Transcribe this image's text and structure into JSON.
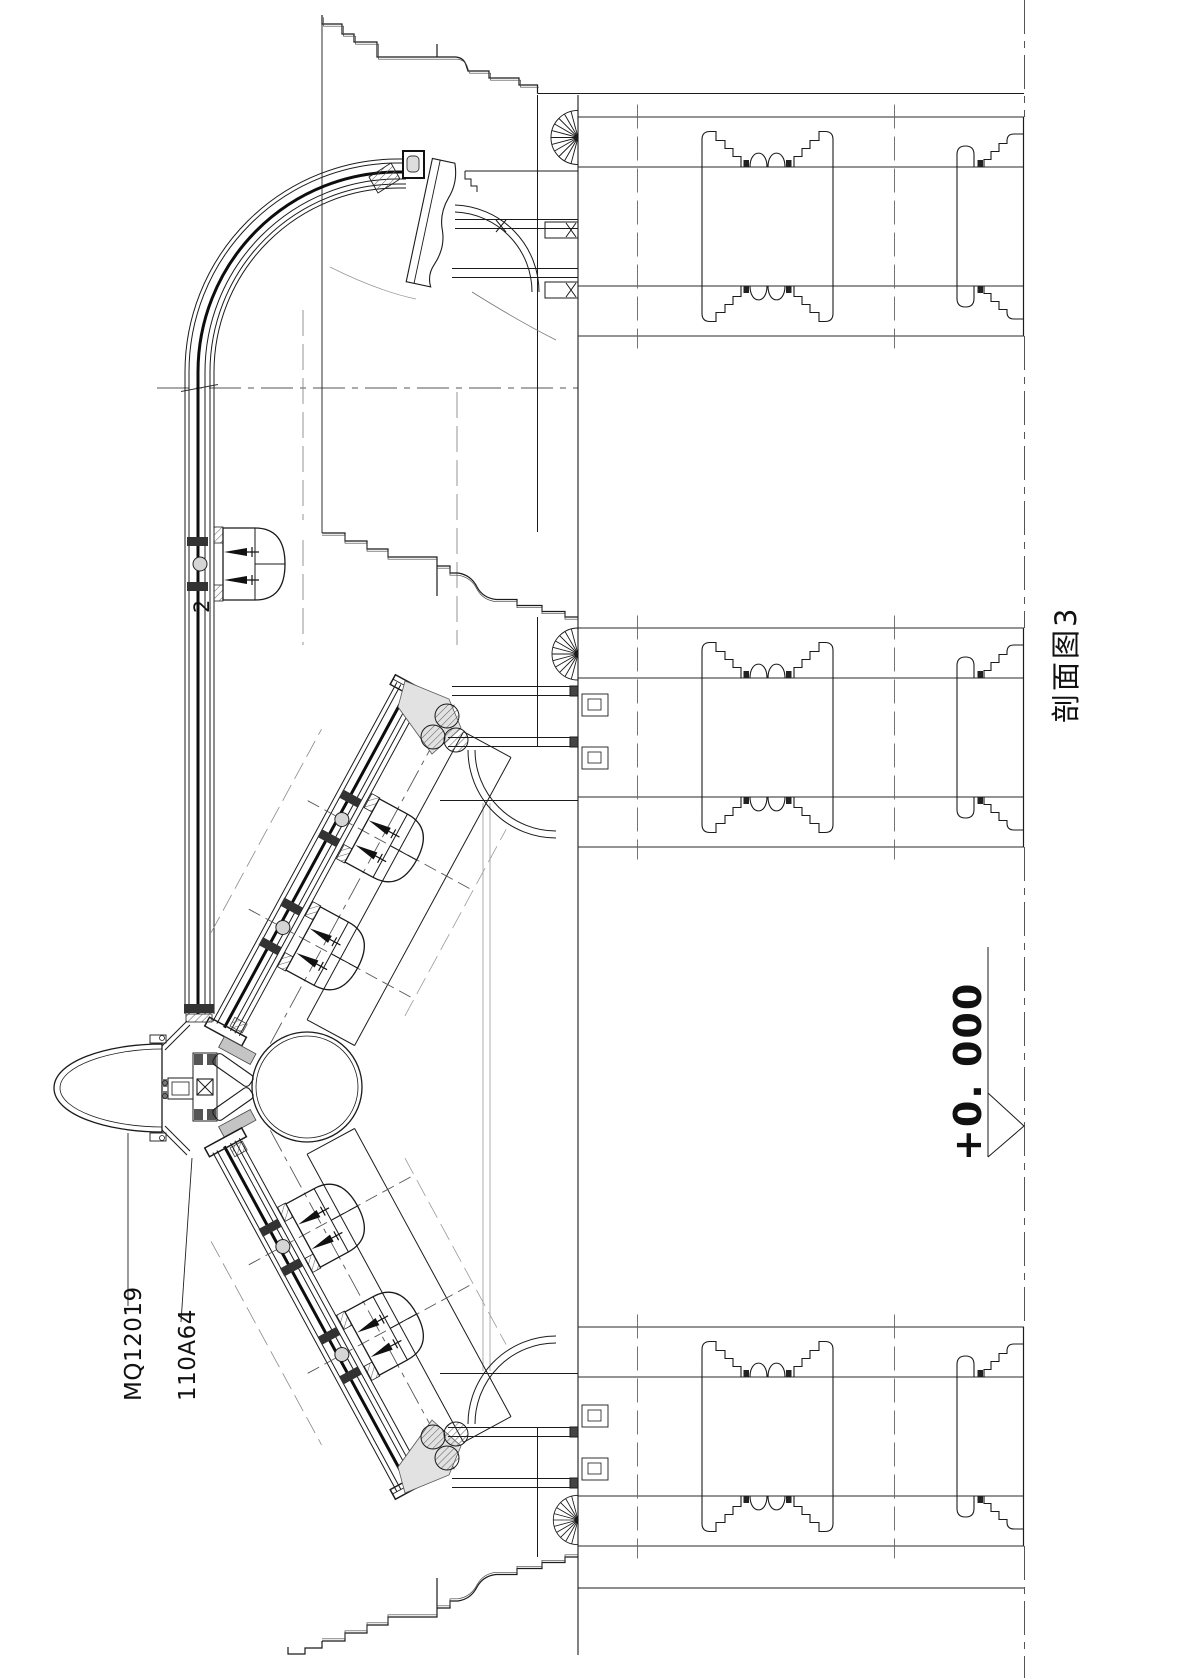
{
  "meta": {
    "kind": "architectural-section-detail",
    "orientation": "rotated-90deg"
  },
  "title": {
    "text": "剖面图3"
  },
  "annotations": {
    "curtainwall_code": "MQ12019",
    "profile_code": "110A64",
    "section_number": "2",
    "elevation_value": "+0. 000"
  },
  "colors": {
    "line": "#1b1b1b",
    "reference": "#8a8a8a",
    "dash": "#555555",
    "background": "#ffffff"
  }
}
